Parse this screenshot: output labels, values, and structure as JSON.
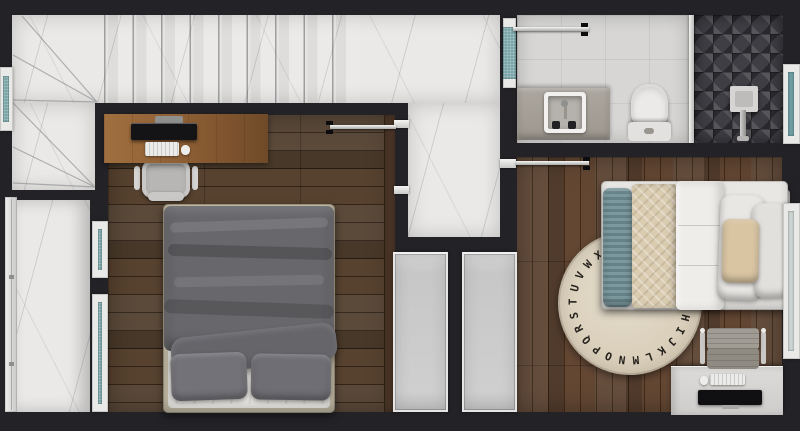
{
  "scene": {
    "description": "Top-down 3D rendered floor plan of an upper storey: staircase, hallway, master bedroom with desk and double bed, bathroom with walk-in shower, second bedroom with single bed, alphabet rug and desk, plus a side balcony strip",
    "width_px": 800,
    "height_px": 431
  },
  "palette": {
    "wall": "#232327",
    "marble": "#eae9e7",
    "tile": "#d7d6d4",
    "shower": "#3e3e44",
    "glassTeal": "#78a5a8",
    "glassPale": "#ccd4d3",
    "closet": "#cdcdcd",
    "rug": "#d8cdb8",
    "rugLetter": "#26231f",
    "duvetGray": "#68686c",
    "pillowGray": "#737278",
    "sheetWhite": "#e4e2de",
    "bedFrameBeige": "#c0b7a2",
    "deskWood": "#96683c",
    "deskWhite": "#d3d2d0",
    "counter": "#a7a29a",
    "fixtureWhite": "#eceae8",
    "tealPillow": "#6d8d93",
    "throwBeige": "#d9ccb1",
    "accentPillow": "#d9c5a2",
    "monitor": "#141417",
    "woodDark": "#4a3628",
    "woodWarm": "#56402f"
  },
  "rug": {
    "letters": "ABCDEFGHIJKLMNOPQRSTUVWXYZ",
    "visible_letters": "HIJKLMNOPQRSTUVWX",
    "start_deg": 8,
    "step_deg": 13.846,
    "radius_px": 57
  },
  "rooms": {
    "staircase": {
      "features": [
        "winder-steps",
        "straight-treads",
        "left-window"
      ]
    },
    "hallway": {
      "features": [
        "marble-floor",
        "frosted-glass-panel"
      ]
    },
    "bedroom_1": {
      "floor": "dark-walnut-planks",
      "furniture": [
        "wood-desk",
        "monitor",
        "keyboard",
        "mouse",
        "office-chair",
        "double-bed",
        "built-in-wardrobe"
      ]
    },
    "bathroom": {
      "fixtures": [
        "vanity-sink",
        "toilet",
        "walk-in-shower",
        "rain-shower-head",
        "glass-partition",
        "window"
      ]
    },
    "bedroom_2": {
      "floor": "warm-walnut-planks",
      "furniture": [
        "single-bed",
        "alphabet-rug",
        "white-desk",
        "monitor",
        "keyboard",
        "mouse",
        "chair",
        "built-in-wardrobe",
        "headboard"
      ]
    },
    "balcony": {
      "features": [
        "marble-floor",
        "full-height-glazing"
      ]
    }
  },
  "doors": [
    {
      "room": "bathroom",
      "state": "open"
    },
    {
      "room": "bedroom_1",
      "state": "open"
    },
    {
      "room": "bedroom_2",
      "state": "open"
    }
  ],
  "windows": [
    "staircase-left",
    "bedroom-1-left-upper",
    "bedroom-1-left-lower",
    "bathroom-right",
    "bedroom-2-right"
  ]
}
